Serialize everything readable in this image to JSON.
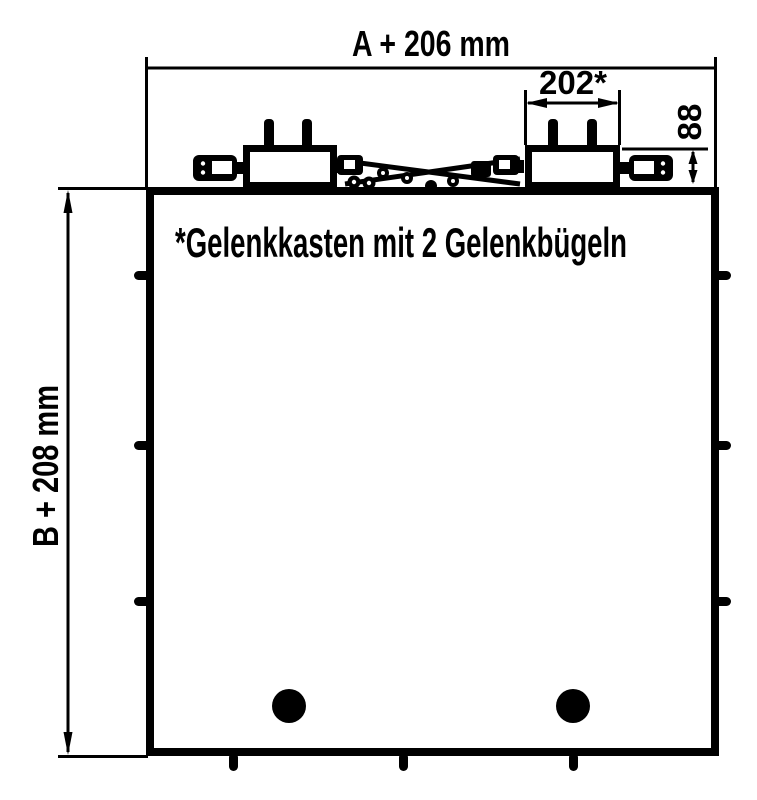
{
  "drawing": {
    "title": "Gelenkkasten technical drawing",
    "dimensions": {
      "width_label": "A + 206 mm",
      "height_label": "B + 208 mm",
      "gelenkkasten_width_label": "202*",
      "gelenkkasten_height_label": "88"
    },
    "footnote": "*Gelenkkasten mit 2 Gelenkbügeln",
    "colors": {
      "line": "#000000",
      "background": "#ffffff"
    }
  }
}
